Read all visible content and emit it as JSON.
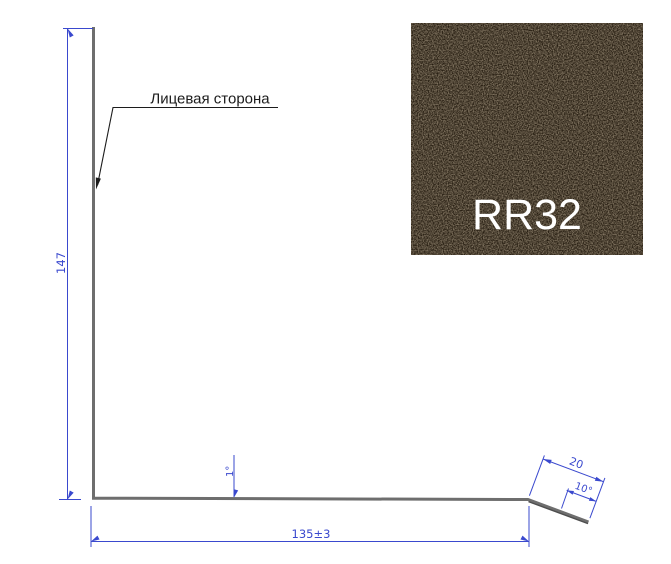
{
  "colors": {
    "background": "#ffffff",
    "dimension_blue": "#3a49ce",
    "profile_gray": "#6e6e6e",
    "profile_shadow": "#4e4e4e",
    "leader_black": "#1c1c1c",
    "swatch_base": "#251c10",
    "swatch_speckle": "#584832",
    "swatch_text": "#ffffff"
  },
  "drawing": {
    "face_label": "Лицевая сторона",
    "height_dim": "147",
    "width_dim": "135±3",
    "bottom_angle_dim": "1°",
    "flange_length_dim": "20",
    "flange_angle_dim": "10°"
  },
  "swatch": {
    "code": "RR32"
  }
}
